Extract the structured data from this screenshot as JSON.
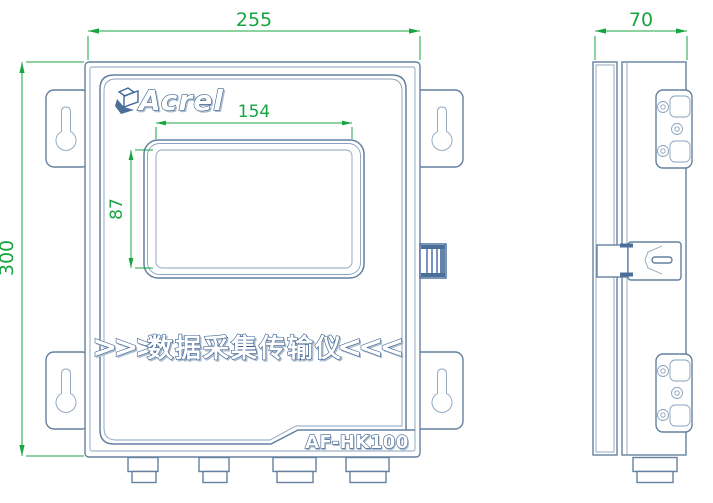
{
  "drawing_title": "AF-HK100 enclosure dimension drawing",
  "colors": {
    "line_blue": "#64809f",
    "accent_dark_blue": "#41689b",
    "dimension_green": "#16a53f",
    "text_outline_navy": "#3a5f8e",
    "background": "#ffffff"
  },
  "front_view": {
    "brand_logo": "Acrel",
    "banner": {
      "prefix": ">>>",
      "text": "数据采集传输仪",
      "suffix": "<<<"
    },
    "model_label": "AF-HK100",
    "dims": {
      "overall_width": "255",
      "overall_height": "300",
      "screen_width": "154",
      "screen_height": "87"
    }
  },
  "side_view": {
    "dims": {
      "depth": "70"
    }
  }
}
